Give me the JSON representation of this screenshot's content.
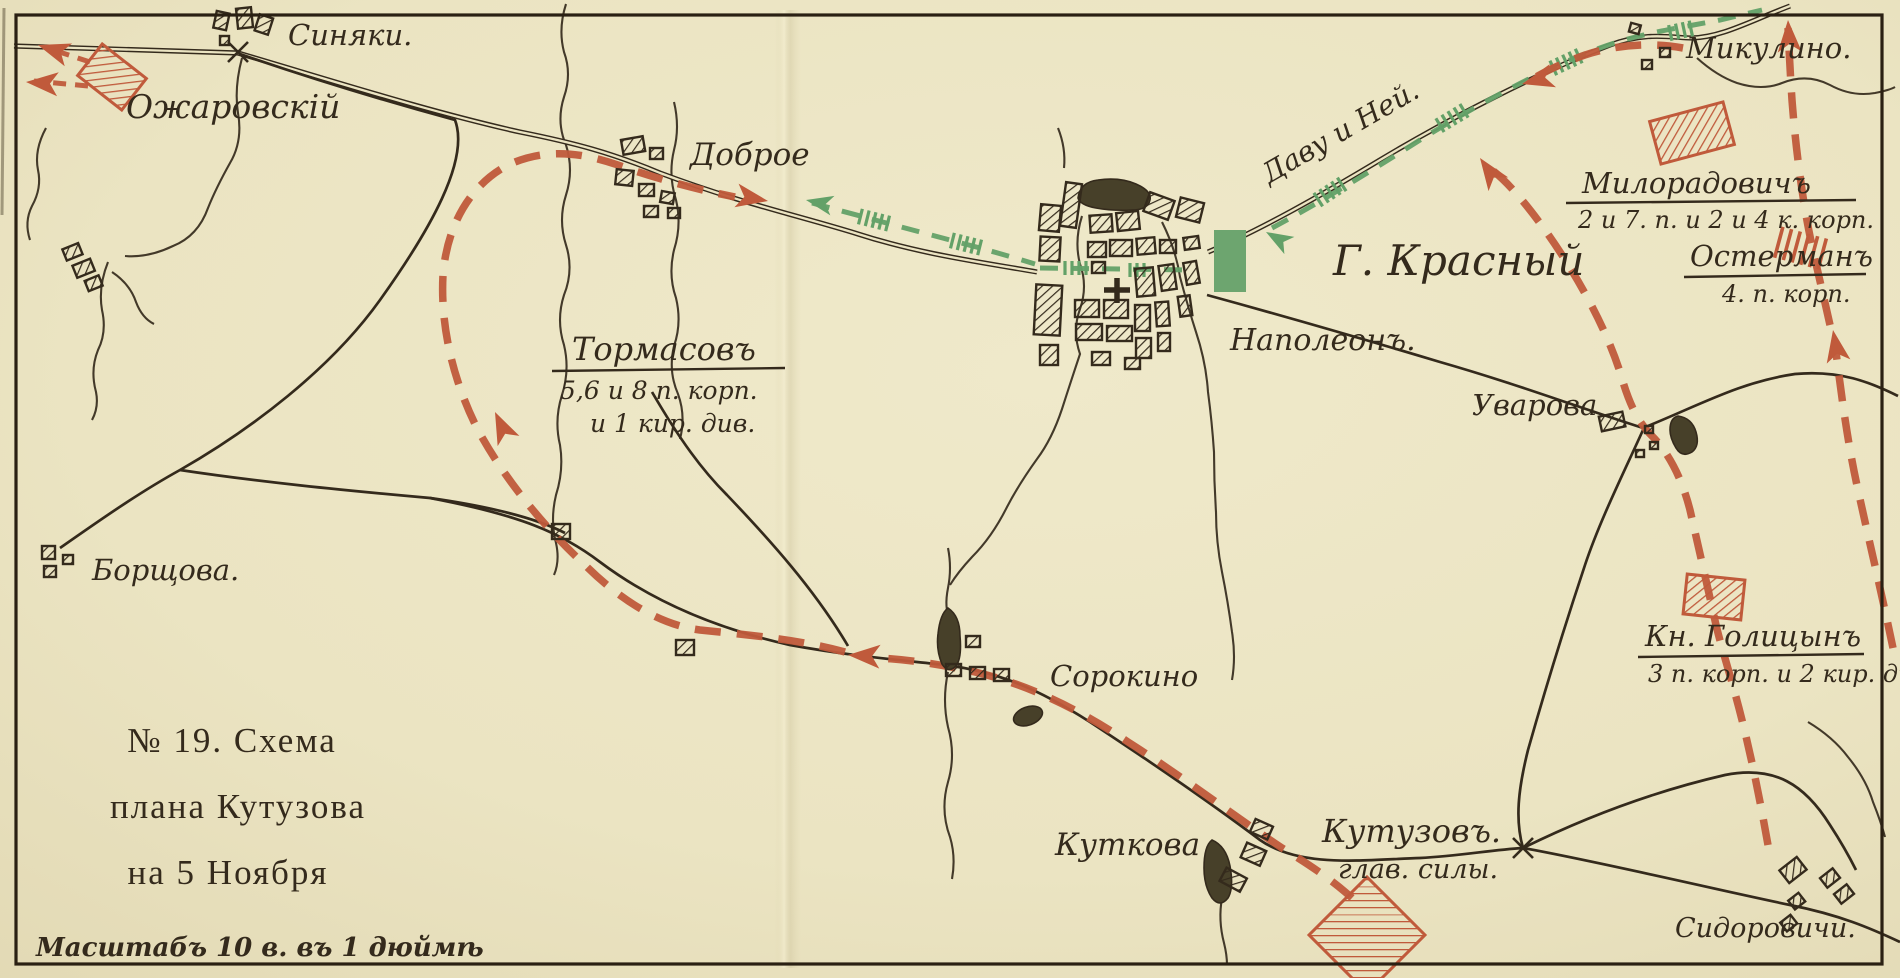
{
  "map": {
    "title_lines": {
      "l1": "№ 19. Схема",
      "l2": "плана Кутузова",
      "l3": "на 5 Ноября"
    },
    "scale_note": "Масштабъ 10 в. въ 1 дюймѣ",
    "places": {
      "sinyaki": "Синяки.",
      "dobroe": "Доброе",
      "borshchova": "Борщова.",
      "krasny": "Г. Красный",
      "mikulino": "Микулино.",
      "uvarova": "Уварова",
      "sorokino": "Сорокино",
      "kutkova": "Куткова",
      "sidorovichi": "Сидоровичи."
    },
    "forces": {
      "ozharovsky": "Ожаровскій",
      "tormasov": "Тормасовъ",
      "tormasov_sub1": "5,6 и 8 п. корп.",
      "tormasov_sub2": "и 1 кир. див.",
      "napoleon": "Наполеонъ.",
      "davout_ney": "Даву и Ней.",
      "miloradovich": "Милорадовичъ",
      "miloradovich_sub": "2 и 7. п. и 2 и 4 к. корп.",
      "ostermann": "Остерманъ",
      "ostermann_sub": "4. п. корп.",
      "golitsyn": "Кн. Голицынъ",
      "golitsyn_sub": "3 п. корп. и 2 кир. див",
      "kutuzov": "Кутузовъ.",
      "kutuzov_sub": "глав. силы."
    }
  },
  "colors": {
    "paper": "#ebe4c2",
    "ink": "#342a1c",
    "russian": "#c05a3b",
    "french": "#63a168"
  }
}
